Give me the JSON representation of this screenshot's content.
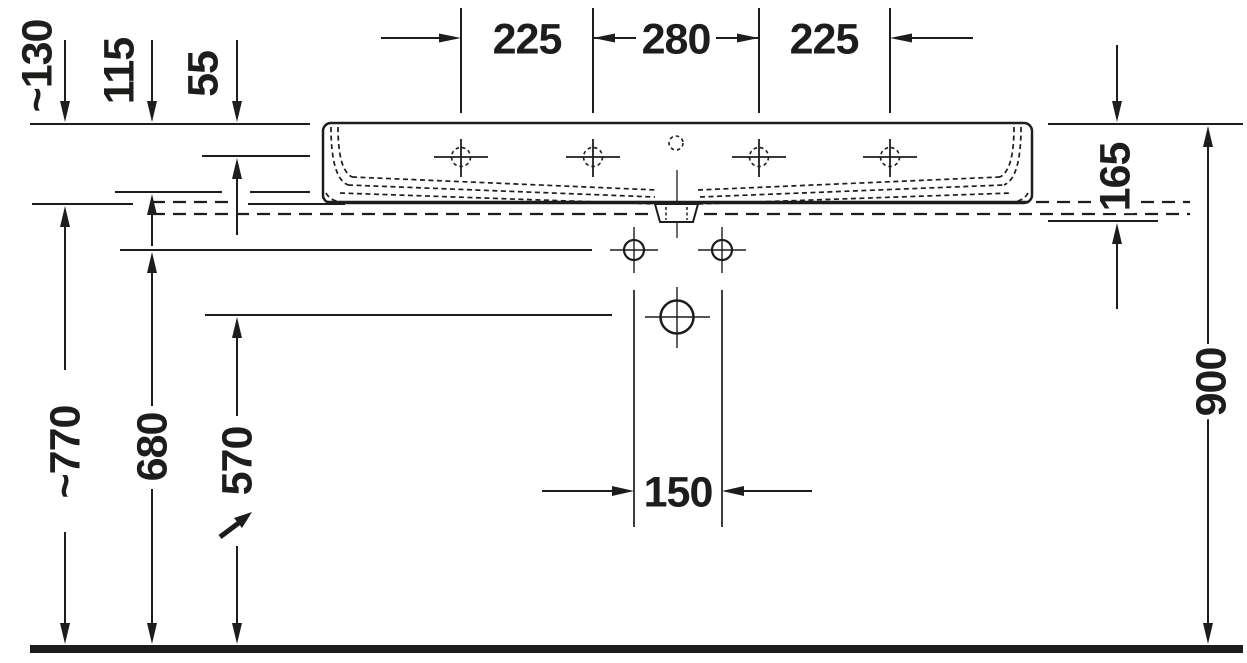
{
  "drawing": {
    "kind": "washbasin-front-elevation-technical-drawing",
    "units": "mm",
    "colors": {
      "ink": "#1d1d1b",
      "background": "#ffffff"
    },
    "dimensions": {
      "top": [
        "225",
        "280",
        "225"
      ],
      "upper_left": [
        "~130",
        "115",
        "55"
      ],
      "lower_left": [
        "~770",
        "680",
        "570"
      ],
      "right": [
        "165",
        "900"
      ],
      "center": [
        "150"
      ]
    }
  }
}
